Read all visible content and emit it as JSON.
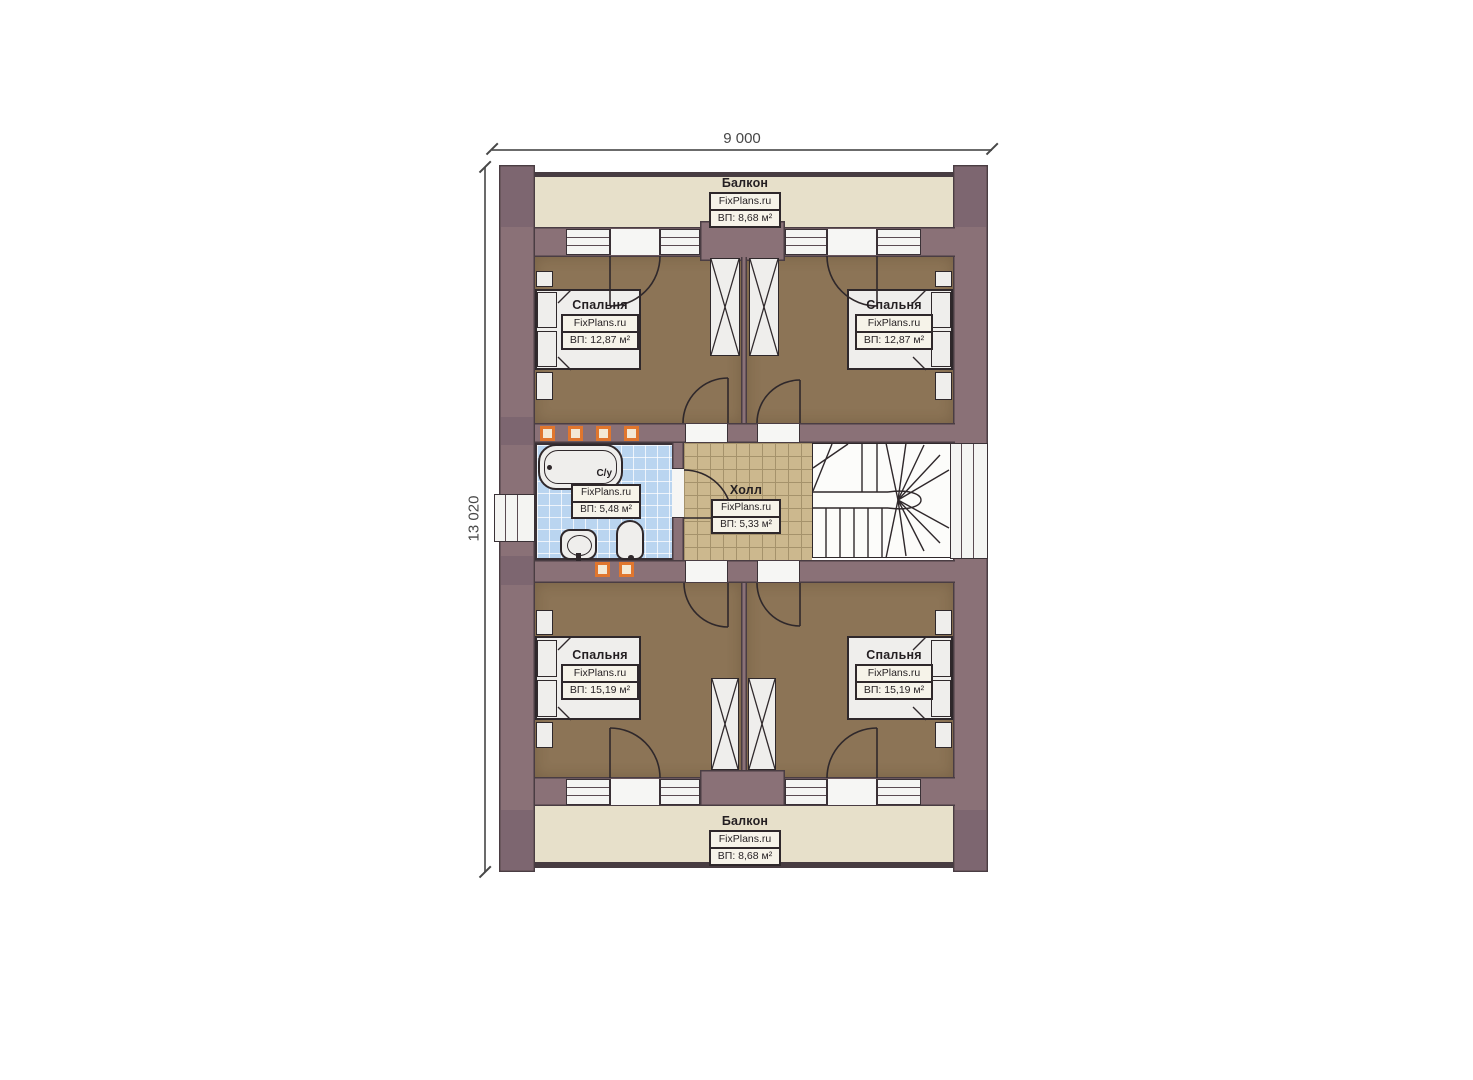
{
  "dimensions": {
    "top": "9 000",
    "left": "13 020"
  },
  "rooms": {
    "balcony_top": {
      "name": "Балкон",
      "brand": "FixPlans.ru",
      "area": "ВП: 8,68 м²"
    },
    "bedroom_top_left": {
      "name": "Спальня",
      "brand": "FixPlans.ru",
      "area": "ВП: 12,87 м²"
    },
    "bedroom_top_right": {
      "name": "Спальня",
      "brand": "FixPlans.ru",
      "area": "ВП: 12,87 м²"
    },
    "bathroom": {
      "name": "С/у",
      "brand": "FixPlans.ru",
      "area": "ВП: 5,48 м²"
    },
    "hall": {
      "name": "Холл",
      "brand": "FixPlans.ru",
      "area": "ВП: 5,33 м²"
    },
    "bedroom_bottom_left": {
      "name": "Спальня",
      "brand": "FixPlans.ru",
      "area": "ВП: 15,19 м²"
    },
    "bedroom_bottom_right": {
      "name": "Спальня",
      "brand": "FixPlans.ru",
      "area": "ВП: 15,19 м²"
    },
    "balcony_bottom": {
      "name": "Балкон",
      "brand": "FixPlans.ru",
      "area": "ВП: 8,68 м²"
    }
  },
  "colors": {
    "wall": "#8a7177",
    "bedroom_floor": "#8c7456",
    "balcony_floor": "#e7e0ca",
    "bath_tile": "#bad5f0",
    "hall_tile": "#ccb88e",
    "marker_orange": "#e0762e",
    "linework": "#2f282b"
  }
}
